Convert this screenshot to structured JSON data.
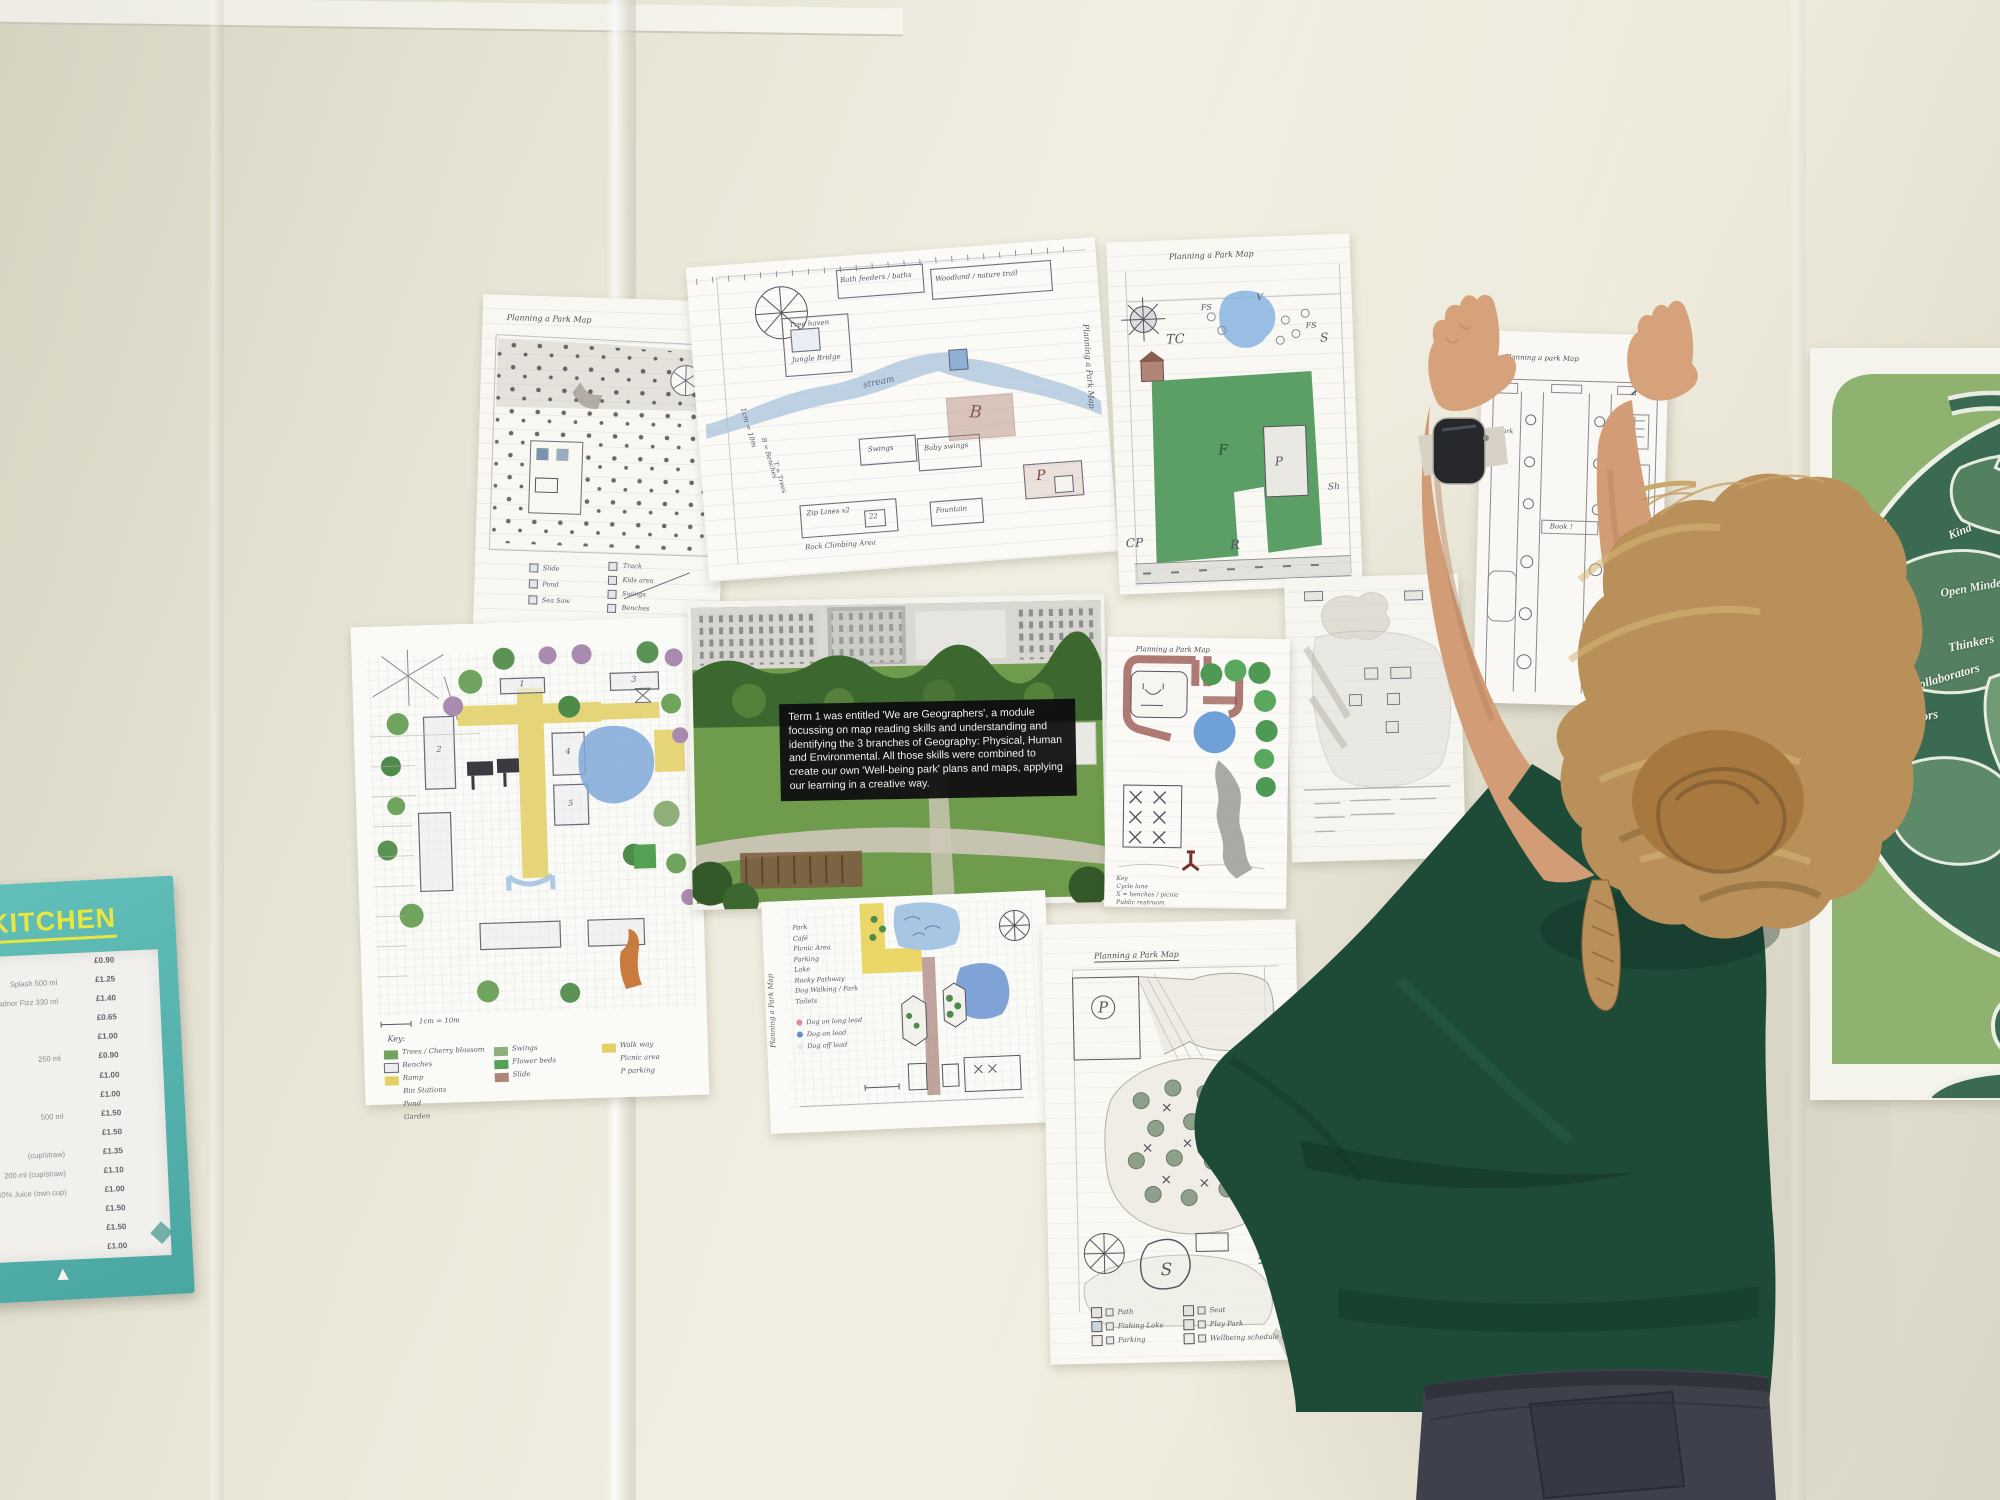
{
  "colors": {
    "wall": "#ece9da",
    "kitchen_teal": "#57b6b0",
    "kitchen_yellow": "#e9e73f",
    "poster_light_green": "#8fb271",
    "poster_dark_green": "#3a6a52",
    "shirt_green": "#1d4b38",
    "hair_blonde": "#b9905a",
    "skin": "#d29c76",
    "crayon_green": "#4e9a55",
    "crayon_blue": "#7fa8d9",
    "caption_bg": "#0e0e10"
  },
  "compass": {
    "n": "N",
    "e": "E",
    "s": "S",
    "w": "W"
  },
  "kitchen_sign": {
    "prefix": "LI",
    "title": "KITCHEN",
    "logo_glyph": "▲",
    "menu_rows": [
      {
        "item": "",
        "price": "£0.90"
      },
      {
        "item": "Splash 500 ml",
        "price": "£1.25"
      },
      {
        "item": "Radnor Fizz 330 ml",
        "price": "£1.40"
      },
      {
        "item": "",
        "price": "£0.65"
      },
      {
        "item": "",
        "price": "£1.00"
      },
      {
        "item": "250 ml",
        "price": "£0.90"
      },
      {
        "item": "",
        "price": "£1.00"
      },
      {
        "item": "",
        "price": "£1.00"
      },
      {
        "item": "500 ml",
        "price": "£1.50"
      },
      {
        "item": "",
        "price": "£1.50"
      },
      {
        "item": "(cup/straw)",
        "price": "£1.35"
      },
      {
        "item": "200 ml (cup/straw)",
        "price": "£1.10"
      },
      {
        "item": "40% Juice (own cup)",
        "price": "£1.00"
      },
      {
        "item": "",
        "price": "£1.50"
      },
      {
        "item": "",
        "price": "£1.50"
      },
      {
        "item": "",
        "price": "£1.00"
      }
    ]
  },
  "photo_panel": {
    "caption": "Term 1 was entitled 'We are Geographers', a module focussing on map reading skills and understanding and identifying the 3 branches of Geography: Physical, Human and Environmental. All those skills were combined to create our own 'Well-being park' plans and maps, applying our learning in a creative way."
  },
  "poster": {
    "words": [
      "Self-Aware",
      "Kind",
      "Globally - Aware",
      "Open Minded",
      "Thinkers",
      "Collaborators",
      "Creators",
      "Communicators"
    ]
  },
  "maps": {
    "dotted": {
      "title": "Planning a Park Map",
      "legend_col1": [
        "Slide",
        "Pond",
        "Sea Saw"
      ],
      "legend_col2": [
        "Track",
        "Kids area",
        "Swings",
        "Benches",
        "Astroturf"
      ]
    },
    "stream": {
      "title": "Planning a Park Map",
      "scale": "1cm = 10m",
      "key_b": "B = Benches",
      "key_t": "T = Trees",
      "tree_haven": "Tree haven",
      "jungle_bridge": "Jungle Bridge",
      "bath": "Bath feeders / baths",
      "woodland": "Woodland / nature trail",
      "stream_label": "stream",
      "swings": "Swings",
      "baby_swings": "Baby swings",
      "b": "B",
      "zip": "Zip Lines x2",
      "zip_count": "22",
      "fountain": "Fountain",
      "p": "P",
      "rock": "Rock Climbing Area"
    },
    "green": {
      "title": "Planning a Park Map",
      "tc": "TC",
      "fs1": "FS",
      "v": "V",
      "fs2": "FS",
      "s": "S",
      "f": "F",
      "p": "P",
      "sh": "Sh",
      "cp": "CP",
      "r": "R"
    },
    "held": {
      "title": "Planning a park Map",
      "park1": "Park",
      "park2": "Park",
      "book": "Book !"
    },
    "colorful": {
      "key": "Key:",
      "scale": "1cm = 10m",
      "n1": "1",
      "n2": "2",
      "n3": "3",
      "n4": "4",
      "n5": "5",
      "legend_col1": [
        "Trees / Cherry blossom",
        "Benches",
        "Ramp",
        "Bin Stations",
        "Pond",
        "Garden"
      ],
      "legend_col2": [
        "Swings",
        "Flower beds",
        "Slide"
      ],
      "legend_col3": [
        "Walk way",
        "Picnic area",
        "P  parking"
      ]
    },
    "red_path": {
      "title": "Planning a Park Map",
      "e": "E",
      "legend": [
        "Key",
        "Cycle lane",
        "X = benches / picnic",
        "Public restroom"
      ]
    },
    "yellow_path": {
      "title": "Planning a Park Map",
      "legend": [
        "Park",
        "Café",
        "Picnic Area",
        "Parking",
        "Lake",
        "Rocky Pathway",
        "Dog Walking / Park",
        "Toilets"
      ],
      "dog_legend": [
        "Dog on long lead",
        "Dog on lead",
        "Dog off lead"
      ]
    },
    "fishing": {
      "title": "Planning a Park Map",
      "p": "P",
      "s": "S",
      "legend_col1": [
        "Path",
        "Fishing Lake",
        "Parking"
      ],
      "legend_col2": [
        "Seat",
        "Play Park",
        "Wellbeing schedule shelter"
      ]
    }
  }
}
